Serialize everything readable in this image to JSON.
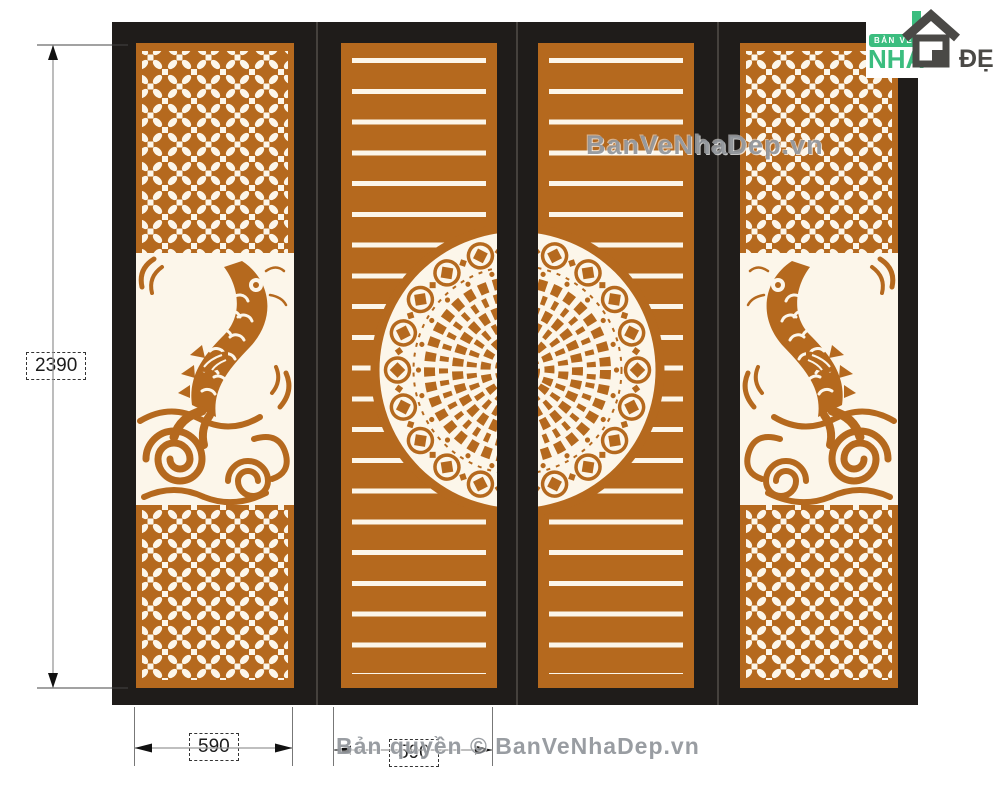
{
  "annotations": {
    "height_label": "2390",
    "door1_width_label": "590",
    "door2_width_label": "590"
  },
  "watermark": {
    "center": "BanVeNhaDep.vn",
    "bottom": "Bản quyền © BanVeNhaDep.vn"
  },
  "logo": {
    "badge": "BẢN VẼ",
    "word_nha": "NHÀ",
    "word_dep": "ĐẸP"
  },
  "drawing": {
    "type": "cnc-gate-elevation",
    "door_count": 4,
    "outer_door_motif": "lattice-with-koi-fish",
    "inner_door_motif": "horizontal-slats-with-coin-mandala"
  },
  "colors": {
    "panel_orange": "#b5691e",
    "frame_black": "#1f1c1a",
    "cutout_white": "#fcf6ea",
    "logo_green": "#3bbd7f",
    "logo_dark": "#4a4946",
    "dimension_line": "#999999",
    "watermark_gray": "#878c92"
  }
}
